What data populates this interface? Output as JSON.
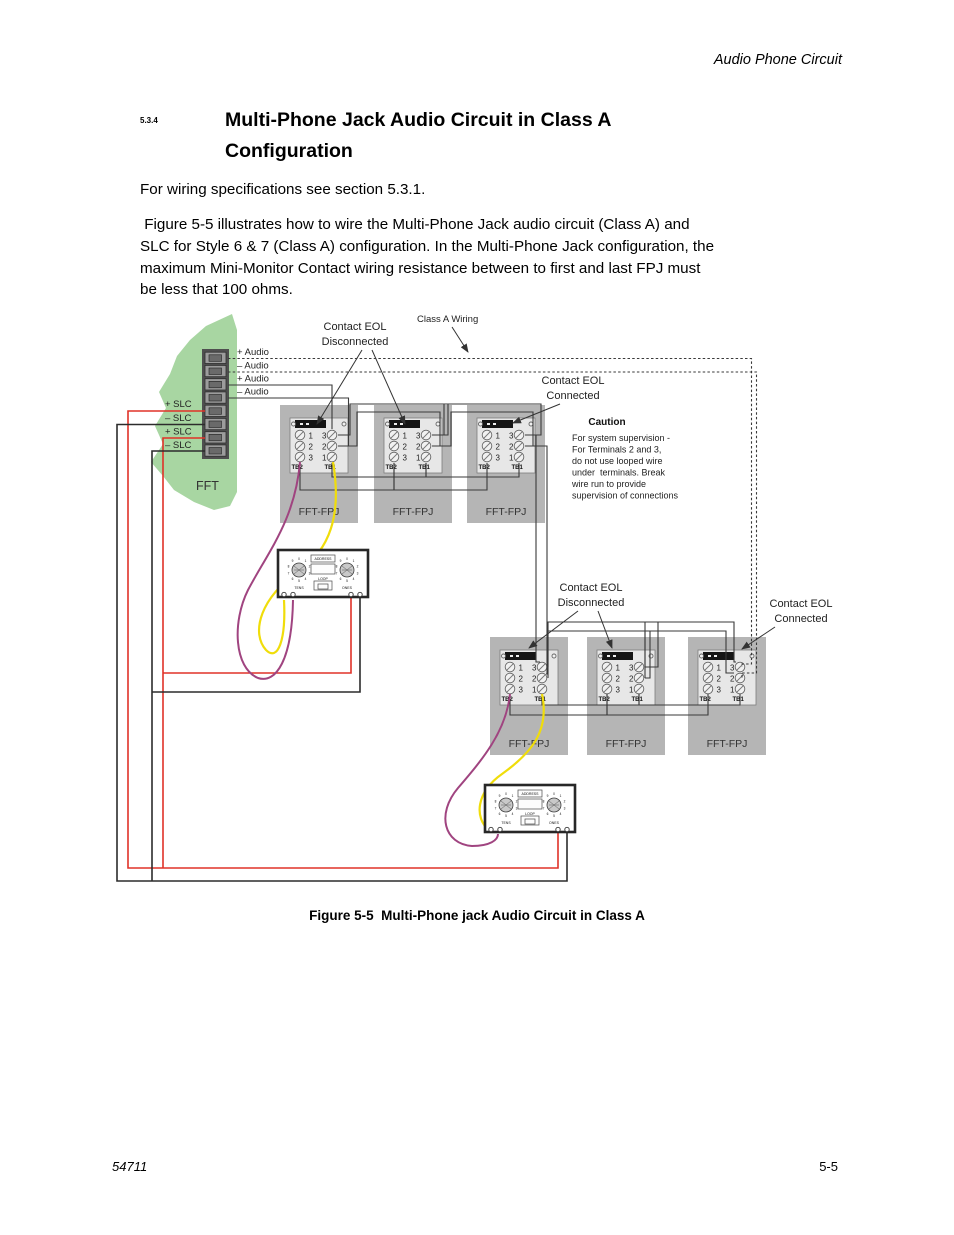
{
  "page": {
    "header": "Audio Phone Circuit",
    "heading": {
      "number": "5.3.4",
      "line1": "Multi-Phone Jack Audio Circuit in Class A",
      "line2": "Configuration"
    },
    "para1": "For wiring specifications see section 5.3.1.",
    "para2": " Figure 5-5 illustrates how to wire the Multi-Phone Jack audio circuit (Class A) and\nSLC for Style 6 & 7 (Class A) configuration. In the Multi-Phone Jack configuration, the\nmaximum Mini-Monitor Contact wiring resistance between to first and last FPJ must\nbe less that 100 ohms.",
    "caption": "Figure 5-5  Multi-Phone jack Audio Circuit in Class A",
    "footer": {
      "left": "54711",
      "right": "5-5"
    }
  },
  "diagram": {
    "labels": {
      "contact_eol": "Contact EOL",
      "disconnected": "Disconnected",
      "connected": "Connected",
      "class_a_wiring": "Class A Wiring",
      "caution_title": "Caution",
      "caution_lines": [
        "For system supervision -",
        "For Terminals 2 and 3,",
        "do not use looped wire",
        "under  terminals. Break",
        "wire run to provide",
        "supervision of connections"
      ],
      "fft": "FFT",
      "audio_plus": "+ Audio",
      "audio_minus": "– Audio",
      "slc_plus": "+ SLC",
      "slc_minus": "– SLC"
    },
    "module": {
      "label": "FFT-FPJ",
      "tb2": "TB2",
      "tb1": "TB1",
      "left_numbers": [
        "1",
        "2",
        "3"
      ],
      "right_numbers": [
        "3",
        "2",
        "1"
      ]
    },
    "device": {
      "address": "ADDRESS",
      "loop": "LOOP",
      "tens": "TENS",
      "ones": "ONES",
      "digits": [
        "0",
        "1",
        "2",
        "3",
        "4",
        "5",
        "6",
        "7",
        "8",
        "9"
      ]
    },
    "colors": {
      "slc_red": "#e03228",
      "wire_yellow": "#f0dd0a",
      "wire_purple": "#a04480",
      "fft_green": "#a8d6a2",
      "module_gray": "#b5b5b5",
      "board_gray": "#e7e7e7",
      "wire_dark": "#3a3a3a"
    }
  }
}
